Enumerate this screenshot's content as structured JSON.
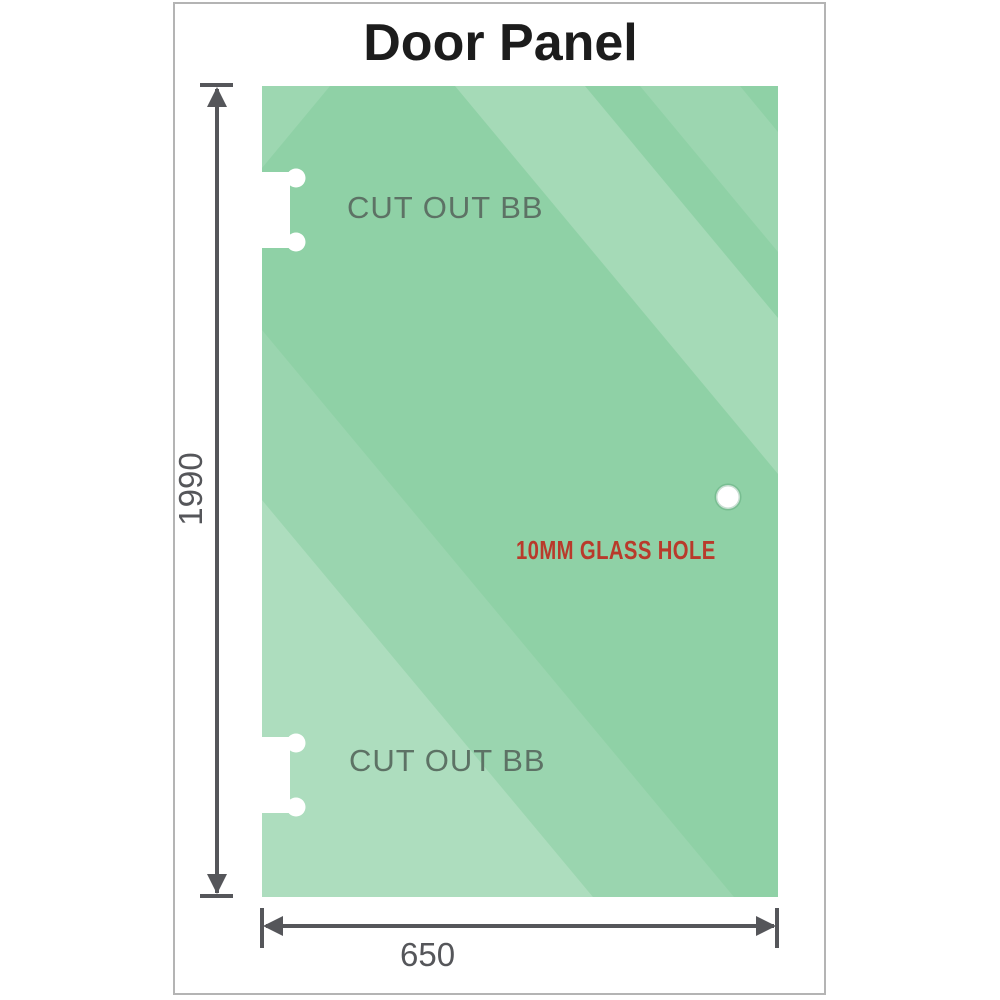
{
  "title": "Door Panel",
  "panel": {
    "cutouts": [
      {
        "position": "top",
        "label": "CUT OUT BB"
      },
      {
        "position": "bottom",
        "label": "CUT OUT BB"
      }
    ],
    "glass_hole": {
      "label": "10MM GLASS HOLE"
    }
  },
  "dimensions": {
    "height": {
      "value": "1990"
    },
    "width": {
      "value": "650"
    }
  },
  "colors": {
    "background": "#ffffff",
    "panel-green": "#8fd1a6",
    "streak-white": "#ffffff",
    "frame-border": "#b4b4b4",
    "dim-gray": "#55565a",
    "cutout-label-gray": "#5d7265",
    "hole-label-red": "#b93a2b",
    "title-black": "#1c1c1c"
  }
}
